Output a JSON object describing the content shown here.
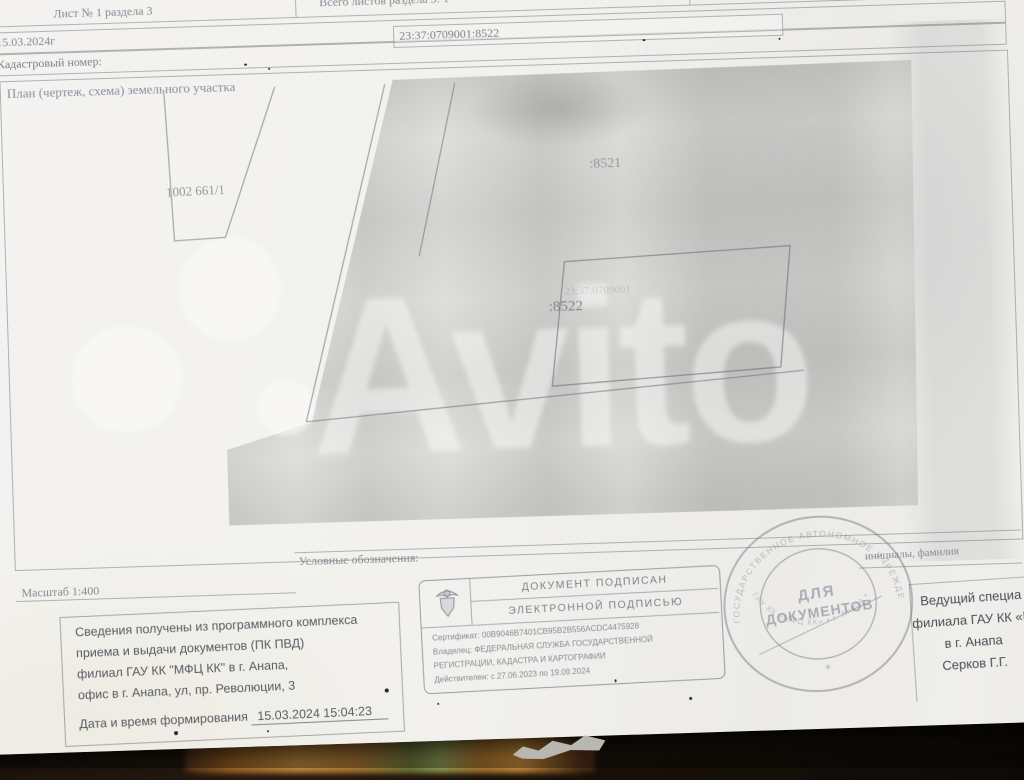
{
  "watermark": "Avito",
  "header": {
    "sheet": "Лист № 1 раздела 3",
    "total": "Всего листов раздела 3: 1",
    "date": "15.03.2024г",
    "cadnum_label": "Кадастровый номер:",
    "cadnum": "23:37:0709001:8522",
    "plan_title": "План (чертеж, схема) земельного участка"
  },
  "plan": {
    "label_left": "1002 661/1",
    "label_8521": ":8521",
    "label_8522": ":8522",
    "label_8522_cad": "23:37:0709001"
  },
  "legend": {
    "scale": "Масштаб 1:400",
    "legend_label": "Условные обозначения:",
    "initials_label": "инициалы, фамилия"
  },
  "info_block": {
    "line1": "Сведения получены из программного комплекса",
    "line2": "приема и выдачи документов (ПК ПВД)",
    "line3": "филиал ГАУ КК \"МФЦ КК\" в г. Анапа,",
    "line4": "офис в г. Анапа, ул, пр. Революции, 3",
    "date_label": "Дата и время формирования",
    "date_value": "15.03.2024  15:04:23"
  },
  "esign": {
    "title1": "ДОКУМЕНТ ПОДПИСАН",
    "title2": "ЭЛЕКТРОННОЙ ПОДПИСЬЮ",
    "cert": "Сертификат: 00B9046B7401CB95B2B556ACDC4475928",
    "owner1": "Владелец: ФЕДЕРАЛЬНАЯ СЛУЖБА ГОСУДАРСТВЕННОЙ",
    "owner2": "РЕГИСТРАЦИИ, КАДАСТРА И КАРТОГРАФИИ",
    "valid": "Действителен: с 27.06.2023 по 19.09.2024"
  },
  "round_stamp": {
    "line1": "ДЛЯ",
    "line2": "ДОКУМЕНТОВ",
    "ring_top": "ГОСУДАРСТВЕННОЕ АВТОНОМНОЕ УЧРЕЖДЕНИЕ",
    "ring_bottom": "ГАУ КК «МФЦ КК» • г. Анапа •",
    "star": "*"
  },
  "signer": {
    "line1": "Ведущий специа",
    "line2": "филиала ГАУ КК «М",
    "line3": "в г. Анапа",
    "line4": "Серков Г.Г."
  }
}
